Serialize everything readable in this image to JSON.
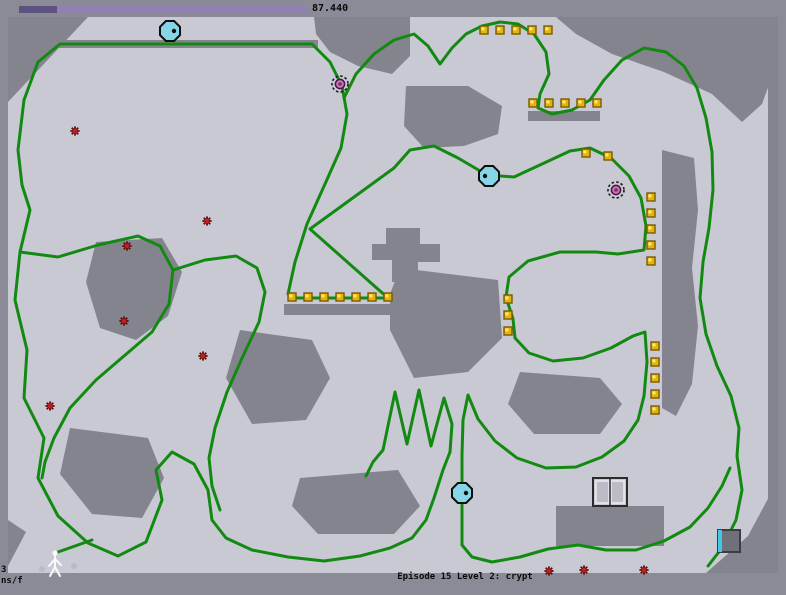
{
  "hud": {
    "timer_value": "87.440",
    "level_label": "Episode 15 Level 2: crypt",
    "debug_line1": "3",
    "debug_line2": "ns/f",
    "timer_bar": {
      "x": 19,
      "y": 6,
      "h": 7,
      "total_w": 289,
      "elapsed_w": 38
    }
  },
  "colors": {
    "outer": "#8b8b97",
    "terrain": "#c9c9d3",
    "wall": "#84848f",
    "trail": "#128a12",
    "gold_fill": "#e3b50a",
    "gold_edge": "#7a5a00",
    "gold_shine": "#ffe87d",
    "mine_spoke": "#5e0a0a",
    "mine_core": "#cf1b1b",
    "drone_fill": "#85d6e6",
    "drone_edge": "#0d0d0d",
    "turret_ring": "#1a1a1a",
    "turret_core": "#c478b4",
    "turret_core_edge": "#4a1243",
    "turret_center": "#7c2a74",
    "door_frame": "#2b2b2b",
    "door_panel": "#bcbcc6",
    "door_panel_edge": "#eceaf2",
    "thwump_body": "#70707a",
    "thwump_edge": "#3c3c44",
    "thwump_face": "#3fc8e8",
    "ninja": "#fafafa",
    "dust": "#b8b8c2",
    "bar_elapsed": "#5e5380",
    "bar_remaining": "#8f81b0",
    "text": "#0a0a0a"
  },
  "map": {
    "x": 8,
    "y": 17,
    "w": 770,
    "h": 556
  },
  "walls": [
    {
      "name": "wall-top-left",
      "points": [
        [
          8,
          17
        ],
        [
          88,
          17
        ],
        [
          8,
          102
        ]
      ]
    },
    {
      "name": "wall-top-ledge",
      "points": [
        [
          50,
          40
        ],
        [
          318,
          40
        ],
        [
          318,
          48
        ],
        [
          50,
          48
        ]
      ]
    },
    {
      "name": "wall-top-center",
      "points": [
        [
          314,
          17
        ],
        [
          410,
          17
        ],
        [
          410,
          56
        ],
        [
          392,
          74
        ],
        [
          358,
          66
        ],
        [
          330,
          52
        ],
        [
          316,
          34
        ]
      ]
    },
    {
      "name": "wall-top-right",
      "points": [
        [
          556,
          17
        ],
        [
          778,
          17
        ],
        [
          778,
          60
        ],
        [
          762,
          104
        ],
        [
          742,
          122
        ],
        [
          712,
          94
        ],
        [
          664,
          72
        ],
        [
          612,
          54
        ],
        [
          576,
          34
        ]
      ]
    },
    {
      "name": "wall-mid-center",
      "points": [
        [
          406,
          86
        ],
        [
          468,
          86
        ],
        [
          502,
          106
        ],
        [
          498,
          134
        ],
        [
          464,
          146
        ],
        [
          424,
          148
        ],
        [
          404,
          126
        ]
      ]
    },
    {
      "name": "wall-left-mid",
      "points": [
        [
          96,
          242
        ],
        [
          162,
          238
        ],
        [
          182,
          272
        ],
        [
          168,
          316
        ],
        [
          136,
          340
        ],
        [
          100,
          328
        ],
        [
          86,
          282
        ]
      ]
    },
    {
      "name": "wall-center-cross",
      "points": [
        [
          386,
          228
        ],
        [
          420,
          228
        ],
        [
          420,
          244
        ],
        [
          440,
          244
        ],
        [
          440,
          262
        ],
        [
          418,
          262
        ],
        [
          418,
          282
        ],
        [
          392,
          282
        ],
        [
          392,
          260
        ],
        [
          372,
          260
        ],
        [
          372,
          244
        ],
        [
          386,
          244
        ]
      ]
    },
    {
      "name": "wall-gold-row3-ledge",
      "points": [
        [
          284,
          304
        ],
        [
          392,
          304
        ],
        [
          392,
          315
        ],
        [
          284,
          315
        ]
      ]
    },
    {
      "name": "wall-gold-row2-ledge",
      "points": [
        [
          528,
          111
        ],
        [
          600,
          111
        ],
        [
          600,
          121
        ],
        [
          528,
          121
        ]
      ]
    },
    {
      "name": "wall-right-column",
      "points": [
        [
          662,
          150
        ],
        [
          694,
          158
        ],
        [
          698,
          210
        ],
        [
          692,
          268
        ],
        [
          698,
          326
        ],
        [
          692,
          384
        ],
        [
          676,
          416
        ],
        [
          662,
          408
        ]
      ]
    },
    {
      "name": "wall-right-border",
      "points": [
        [
          768,
          60
        ],
        [
          778,
          60
        ],
        [
          778,
          573
        ],
        [
          768,
          573
        ]
      ]
    },
    {
      "name": "wall-bottom-right",
      "points": [
        [
          778,
          480
        ],
        [
          778,
          573
        ],
        [
          706,
          573
        ],
        [
          748,
          536
        ]
      ]
    },
    {
      "name": "wall-bottom-left",
      "points": [
        [
          8,
          520
        ],
        [
          26,
          532
        ],
        [
          8,
          566
        ]
      ]
    },
    {
      "name": "wall-mid-left-low",
      "points": [
        [
          70,
          428
        ],
        [
          148,
          438
        ],
        [
          164,
          478
        ],
        [
          142,
          518
        ],
        [
          92,
          514
        ],
        [
          60,
          474
        ]
      ]
    },
    {
      "name": "wall-center-low",
      "points": [
        [
          240,
          330
        ],
        [
          312,
          340
        ],
        [
          330,
          378
        ],
        [
          306,
          420
        ],
        [
          252,
          424
        ],
        [
          226,
          378
        ]
      ]
    },
    {
      "name": "wall-center-mid-big",
      "points": [
        [
          400,
          268
        ],
        [
          498,
          280
        ],
        [
          502,
          338
        ],
        [
          468,
          372
        ],
        [
          414,
          378
        ],
        [
          390,
          330
        ],
        [
          390,
          294
        ]
      ]
    },
    {
      "name": "wall-mid-right-low",
      "points": [
        [
          520,
          372
        ],
        [
          600,
          378
        ],
        [
          622,
          404
        ],
        [
          600,
          434
        ],
        [
          534,
          434
        ],
        [
          508,
          404
        ]
      ]
    },
    {
      "name": "wall-under-door",
      "points": [
        [
          556,
          506
        ],
        [
          664,
          506
        ],
        [
          664,
          546
        ],
        [
          556,
          546
        ]
      ]
    },
    {
      "name": "wall-bottom-center",
      "points": [
        [
          300,
          478
        ],
        [
          398,
          470
        ],
        [
          420,
          506
        ],
        [
          394,
          534
        ],
        [
          318,
          534
        ],
        [
          292,
          506
        ]
      ]
    }
  ],
  "trails": [
    [
      [
        312,
        44
      ],
      [
        60,
        44
      ],
      [
        38,
        62
      ],
      [
        24,
        100
      ],
      [
        18,
        150
      ],
      [
        22,
        185
      ],
      [
        30,
        210
      ],
      [
        20,
        252
      ],
      [
        15,
        300
      ],
      [
        27,
        350
      ],
      [
        24,
        398
      ],
      [
        44,
        438
      ],
      [
        38,
        478
      ],
      [
        58,
        516
      ],
      [
        88,
        543
      ],
      [
        118,
        556
      ],
      [
        146,
        542
      ],
      [
        162,
        500
      ],
      [
        156,
        470
      ],
      [
        172,
        452
      ],
      [
        194,
        464
      ],
      [
        208,
        490
      ],
      [
        212,
        520
      ],
      [
        226,
        538
      ],
      [
        252,
        550
      ],
      [
        288,
        557
      ],
      [
        324,
        561
      ],
      [
        360,
        556
      ],
      [
        390,
        548
      ],
      [
        412,
        538
      ],
      [
        426,
        520
      ],
      [
        434,
        498
      ],
      [
        443,
        470
      ],
      [
        450,
        452
      ]
    ],
    [
      [
        92,
        540
      ],
      [
        58,
        552
      ]
    ],
    [
      [
        312,
        44
      ],
      [
        330,
        62
      ],
      [
        342,
        86
      ],
      [
        347,
        114
      ],
      [
        341,
        148
      ],
      [
        325,
        184
      ],
      [
        307,
        224
      ],
      [
        295,
        262
      ],
      [
        288,
        294
      ],
      [
        292,
        298
      ],
      [
        388,
        298
      ],
      [
        310,
        229
      ],
      [
        394,
        168
      ],
      [
        410,
        150
      ],
      [
        434,
        146
      ],
      [
        458,
        158
      ],
      [
        487,
        175
      ],
      [
        514,
        177
      ],
      [
        542,
        164
      ],
      [
        570,
        151
      ],
      [
        590,
        148
      ],
      [
        611,
        158
      ],
      [
        629,
        176
      ],
      [
        641,
        198
      ],
      [
        646,
        226
      ],
      [
        644,
        250
      ],
      [
        618,
        254
      ],
      [
        596,
        252
      ],
      [
        560,
        252
      ],
      [
        528,
        261
      ],
      [
        509,
        277
      ],
      [
        506,
        297
      ],
      [
        513,
        319
      ],
      [
        515,
        338
      ],
      [
        529,
        353
      ],
      [
        553,
        361
      ],
      [
        583,
        358
      ],
      [
        611,
        348
      ],
      [
        633,
        336
      ],
      [
        645,
        332
      ],
      [
        647,
        362
      ],
      [
        644,
        396
      ],
      [
        638,
        420
      ],
      [
        624,
        441
      ],
      [
        602,
        457
      ],
      [
        576,
        467
      ],
      [
        546,
        468
      ],
      [
        517,
        458
      ],
      [
        495,
        441
      ],
      [
        478,
        419
      ],
      [
        468,
        395
      ],
      [
        463,
        420
      ],
      [
        462,
        455
      ],
      [
        462,
        545
      ],
      [
        472,
        557
      ],
      [
        492,
        562
      ],
      [
        520,
        557
      ],
      [
        548,
        549
      ],
      [
        578,
        545
      ],
      [
        606,
        550
      ],
      [
        636,
        550
      ],
      [
        664,
        541
      ],
      [
        690,
        527
      ],
      [
        708,
        508
      ],
      [
        722,
        486
      ],
      [
        730,
        468
      ]
    ],
    [
      [
        344,
        98
      ],
      [
        356,
        74
      ],
      [
        374,
        54
      ],
      [
        394,
        40
      ],
      [
        414,
        34
      ],
      [
        428,
        46
      ],
      [
        440,
        64
      ],
      [
        452,
        48
      ],
      [
        466,
        34
      ],
      [
        482,
        26
      ],
      [
        500,
        22
      ],
      [
        518,
        24
      ],
      [
        534,
        34
      ],
      [
        546,
        52
      ],
      [
        549,
        74
      ],
      [
        540,
        94
      ],
      [
        538,
        108
      ],
      [
        552,
        114
      ],
      [
        572,
        110
      ],
      [
        590,
        100
      ],
      [
        604,
        80
      ],
      [
        622,
        60
      ],
      [
        644,
        48
      ],
      [
        666,
        52
      ],
      [
        684,
        66
      ],
      [
        697,
        88
      ],
      [
        706,
        118
      ],
      [
        712,
        152
      ],
      [
        713,
        190
      ],
      [
        709,
        228
      ],
      [
        703,
        262
      ],
      [
        700,
        298
      ],
      [
        706,
        334
      ],
      [
        717,
        366
      ],
      [
        731,
        396
      ],
      [
        739,
        428
      ],
      [
        737,
        456
      ],
      [
        742,
        490
      ],
      [
        736,
        520
      ],
      [
        722,
        548
      ],
      [
        708,
        566
      ]
    ],
    [
      [
        20,
        252
      ],
      [
        58,
        257
      ],
      [
        98,
        245
      ],
      [
        138,
        236
      ],
      [
        160,
        246
      ],
      [
        173,
        270
      ],
      [
        169,
        304
      ],
      [
        152,
        332
      ],
      [
        124,
        356
      ],
      [
        96,
        380
      ],
      [
        70,
        408
      ],
      [
        54,
        438
      ],
      [
        45,
        462
      ],
      [
        42,
        478
      ]
    ],
    [
      [
        173,
        270
      ],
      [
        205,
        260
      ],
      [
        236,
        256
      ],
      [
        257,
        268
      ],
      [
        265,
        292
      ],
      [
        259,
        322
      ],
      [
        243,
        356
      ],
      [
        227,
        392
      ],
      [
        215,
        428
      ],
      [
        209,
        458
      ],
      [
        212,
        486
      ],
      [
        220,
        510
      ]
    ],
    [
      [
        450,
        452
      ],
      [
        452,
        424
      ],
      [
        444,
        398
      ],
      [
        431,
        446
      ],
      [
        419,
        390
      ],
      [
        407,
        444
      ],
      [
        395,
        392
      ],
      [
        383,
        450
      ],
      [
        373,
        462
      ],
      [
        366,
        476
      ]
    ]
  ],
  "gold": [
    [
      484,
      30
    ],
    [
      500,
      30
    ],
    [
      516,
      30
    ],
    [
      532,
      30
    ],
    [
      548,
      30
    ],
    [
      533,
      103
    ],
    [
      549,
      103
    ],
    [
      565,
      103
    ],
    [
      581,
      103
    ],
    [
      597,
      103
    ],
    [
      292,
      297
    ],
    [
      308,
      297
    ],
    [
      324,
      297
    ],
    [
      340,
      297
    ],
    [
      356,
      297
    ],
    [
      372,
      297
    ],
    [
      388,
      297
    ],
    [
      586,
      153
    ],
    [
      608,
      156
    ],
    [
      651,
      197
    ],
    [
      651,
      213
    ],
    [
      651,
      229
    ],
    [
      651,
      245
    ],
    [
      651,
      261
    ],
    [
      655,
      346
    ],
    [
      655,
      362
    ],
    [
      655,
      378
    ],
    [
      655,
      394
    ],
    [
      655,
      410
    ],
    [
      508,
      299
    ],
    [
      508,
      315
    ],
    [
      508,
      331
    ]
  ],
  "mines": [
    [
      75,
      131
    ],
    [
      207,
      221
    ],
    [
      127,
      246
    ],
    [
      124,
      321
    ],
    [
      203,
      356
    ],
    [
      50,
      406
    ],
    [
      549,
      571
    ],
    [
      584,
      570
    ],
    [
      644,
      570
    ]
  ],
  "drones": [
    {
      "x": 170,
      "y": 31,
      "eye": "right"
    },
    {
      "x": 489,
      "y": 176,
      "eye": "left"
    },
    {
      "x": 462,
      "y": 493,
      "eye": "right"
    }
  ],
  "turrets": [
    {
      "x": 340,
      "y": 84
    },
    {
      "x": 616,
      "y": 190
    }
  ],
  "door": {
    "x": 593,
    "y": 478,
    "w": 34,
    "h": 28
  },
  "thwump": {
    "x": 718,
    "y": 530,
    "size": 22,
    "face": "left"
  },
  "ninja": {
    "x": 55,
    "y": 552,
    "dust": [
      [
        42,
        569
      ],
      [
        74,
        566
      ]
    ]
  }
}
